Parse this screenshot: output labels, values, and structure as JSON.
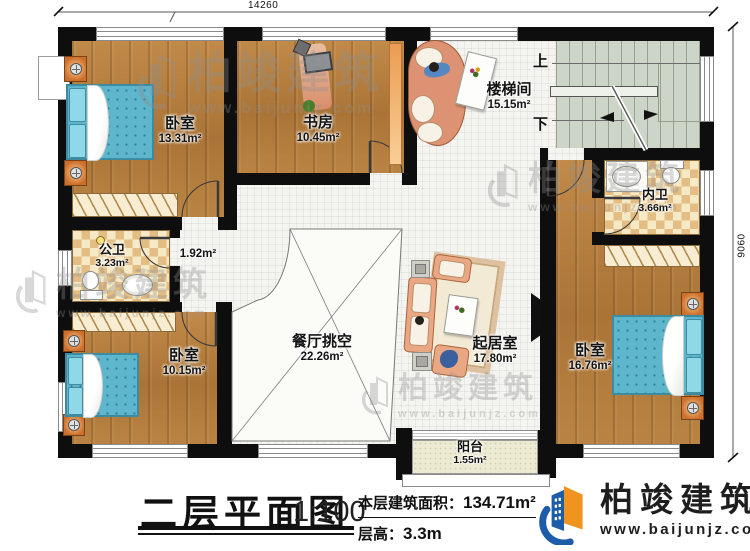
{
  "dims": {
    "width": "14260",
    "height": "9060"
  },
  "stairs": {
    "up": "上",
    "down": "下"
  },
  "rooms": {
    "bedroom_tl": {
      "name": "卧室",
      "area": "13.31m²"
    },
    "study": {
      "name": "书房",
      "area": "10.45m²"
    },
    "stair_hall": {
      "name": "楼梯间",
      "area": "15.15m²"
    },
    "inner_bath": {
      "name": "内卫",
      "area": "3.66m²"
    },
    "public_bath": {
      "name": "公卫",
      "area": "3.23m²"
    },
    "hall": {
      "area": "1.92m²"
    },
    "dining_void": {
      "name": "餐厅挑空",
      "area": "22.26m²"
    },
    "living": {
      "name": "起居室",
      "area": "17.80m²"
    },
    "bedroom_bl": {
      "name": "卧室",
      "area": "10.15m²"
    },
    "bedroom_r": {
      "name": "卧室",
      "area": "16.76m²"
    },
    "balcony": {
      "name": "阳台",
      "area": "1.55m²"
    }
  },
  "title_block": {
    "title": "二层平面图",
    "scale": "1:100",
    "area_label": "本层建筑面积：",
    "area_value": "134.71m²",
    "height_label": "层高：",
    "height_value": "3.3m"
  },
  "brand": {
    "name": "柏竣建筑",
    "site": "www.baijunjz.com"
  },
  "colors": {
    "logo_blue": "#1d5ca8",
    "logo_orange": "#f0941f",
    "wall": "#0e0e0e"
  }
}
